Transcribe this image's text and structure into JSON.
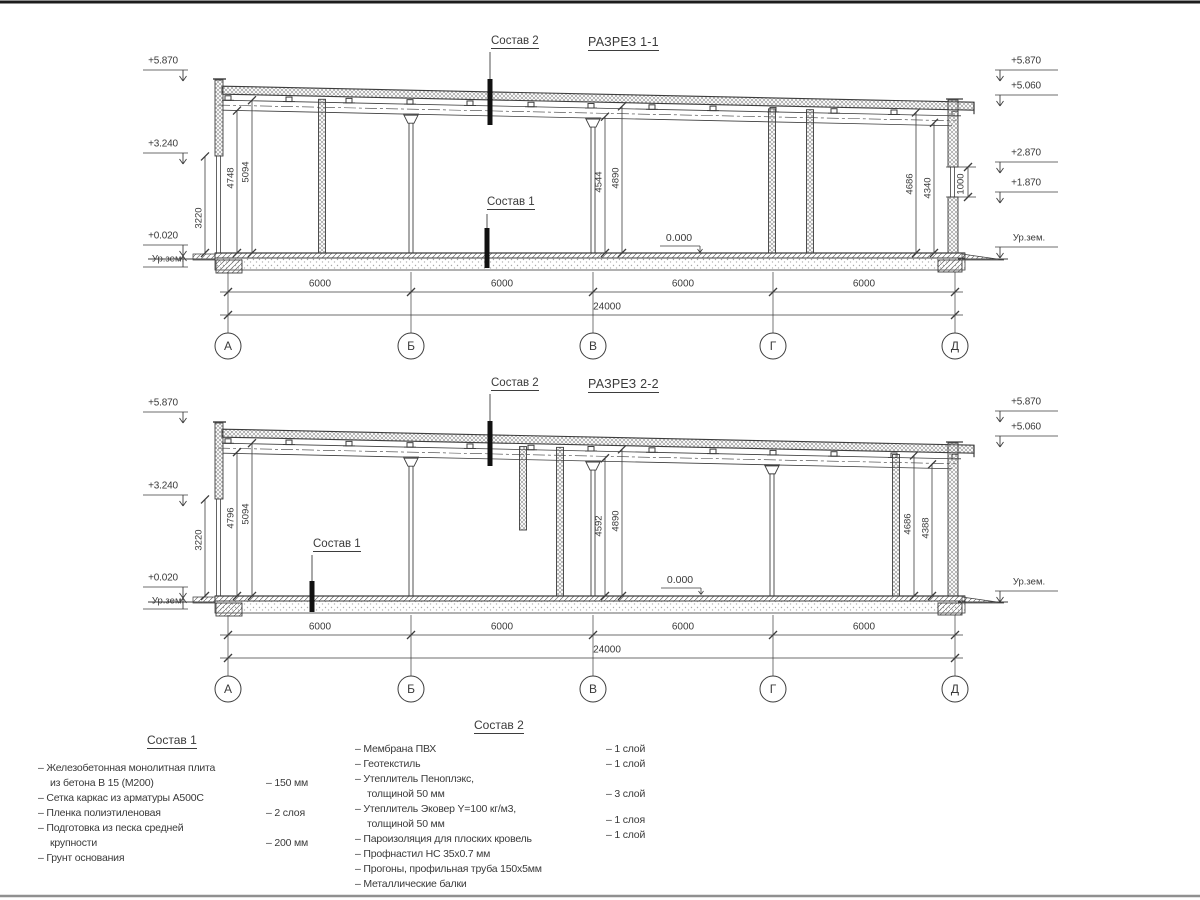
{
  "s1": {
    "title": "РАЗРЕЗ 1-1",
    "cut1": "Состав 1",
    "cut2": "Состав 2",
    "zero": "0.000",
    "levels_left": {
      "l1": "+5.870",
      "l2": "+3.240",
      "l3": "+0.020",
      "ground": "Ур.зем."
    },
    "levels_right": {
      "r1": "+5.870",
      "r2": "+5.060",
      "r3": "+2.870",
      "r4": "+1.870",
      "ground": "Ур.зем."
    },
    "vdims": {
      "a": "3220",
      "b": "4748",
      "c": "5094",
      "d": "4544",
      "e": "4890",
      "f": "4686",
      "g": "4340",
      "h": "1000"
    },
    "spans": [
      "6000",
      "6000",
      "6000",
      "6000"
    ],
    "total": "24000",
    "axes": [
      "А",
      "Б",
      "В",
      "Г",
      "Д"
    ]
  },
  "s2": {
    "title": "РАЗРЕЗ 2-2",
    "cut1": "Состав 1",
    "cut2": "Состав 2",
    "zero": "0.000",
    "levels_left": {
      "l1": "+5.870",
      "l2": "+3.240",
      "l3": "+0.020",
      "ground": "Ур.зем."
    },
    "levels_right": {
      "r1": "+5.870",
      "r2": "+5.060",
      "ground": "Ур.зем."
    },
    "vdims": {
      "a": "3220",
      "b": "4796",
      "c": "5094",
      "d": "4592",
      "e": "4890",
      "f": "4686",
      "g": "4388"
    },
    "spans": [
      "6000",
      "6000",
      "6000",
      "6000"
    ],
    "total": "24000",
    "axes": [
      "А",
      "Б",
      "В",
      "Г",
      "Д"
    ]
  },
  "legend1": {
    "title": "Состав 1",
    "rows": [
      {
        "t": "– Железобетонная  монолитная плита",
        "v": ""
      },
      {
        "t": "из бетона В 15 (М200)",
        "v": "– 150 мм"
      },
      {
        "t": "– Сетка каркас из арматуры А500С",
        "v": ""
      },
      {
        "t": "– Пленка полиэтиленовая",
        "v": "– 2 слоя"
      },
      {
        "t": "– Подготовка из песка средней",
        "v": ""
      },
      {
        "t": "крупности",
        "v": "– 200 мм"
      },
      {
        "t": "– Грунт основания",
        "v": ""
      }
    ]
  },
  "legend2": {
    "title": "Состав 2",
    "rows": [
      {
        "t": "– Мембрана ПВХ",
        "v": "– 1 слой"
      },
      {
        "t": "– Геотекстиль",
        "v": "– 1 слой"
      },
      {
        "t": "– Утеплитель Пеноплэкс,",
        "v": ""
      },
      {
        "t": "толщиной 50 мм",
        "v": "– 3 слой"
      },
      {
        "t": "– Утеплитель Эковер Y=100 кг/м3,",
        "v": ""
      },
      {
        "t": "толщиной 50 мм",
        "v": "– 1 слоя"
      },
      {
        "t": "– Пароизоляция для плоских кровель",
        "v": "– 1 слой"
      },
      {
        "t": "– Профнастил НС 35х0.7 мм",
        "v": ""
      },
      {
        "t": "– Прогоны, профильная труба 150х5мм",
        "v": ""
      },
      {
        "t": "– Металлические балки",
        "v": ""
      }
    ]
  }
}
